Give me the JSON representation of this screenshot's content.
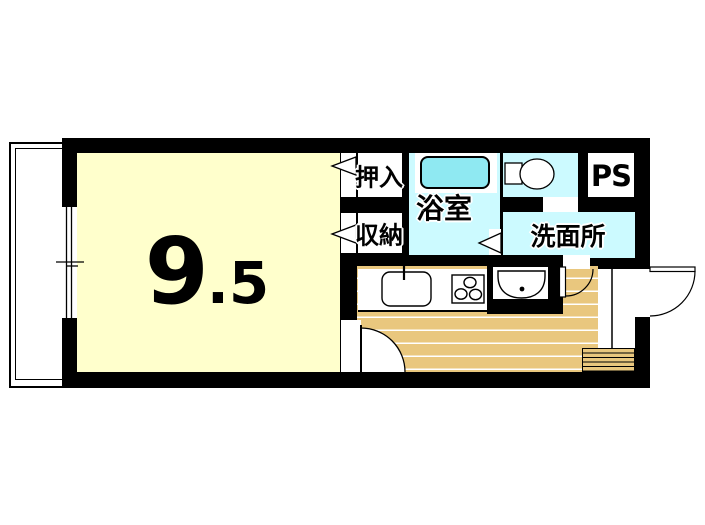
{
  "plan": {
    "title": "studio-apartment-floor-plan",
    "labels": {
      "room_size_main": "9",
      "room_size_decimal": ".5",
      "closet": "押入",
      "storage": "収納",
      "bathroom": "浴室",
      "washroom": "洗面所",
      "pipe_space": "PS"
    },
    "fixtures": [
      "bathtub",
      "toilet",
      "washbasin",
      "kitchen-sink",
      "stove",
      "shoe-step",
      "balcony",
      "window",
      "entrance-door"
    ]
  },
  "colors": {
    "background": "#FFFFFF",
    "wall": "#000000",
    "room_floor": "#FFFFCC",
    "wet_floor": "#CCFAFF",
    "bathtub": "#8FE9F2",
    "wood_floor": "#E9C77E",
    "line": "#000000"
  }
}
